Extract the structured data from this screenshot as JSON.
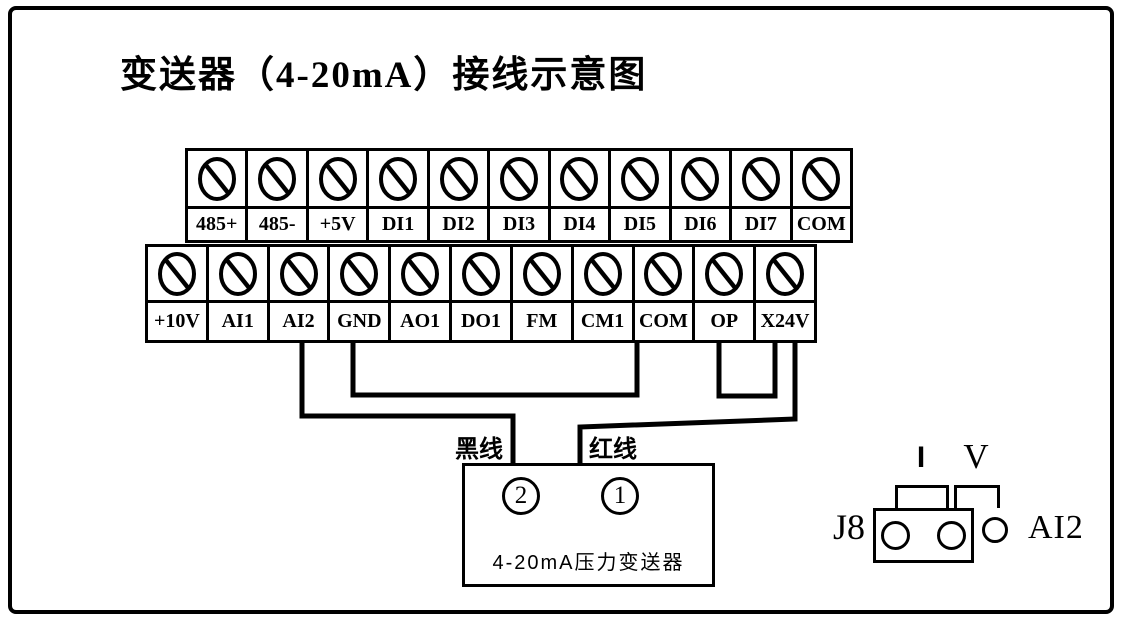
{
  "title": "变送器（4-20mA）接线示意图",
  "terminal_block": {
    "top_row": [
      "485+",
      "485-",
      "+5V",
      "DI1",
      "DI2",
      "DI3",
      "DI4",
      "DI5",
      "DI6",
      "DI7",
      "COM"
    ],
    "bottom_row": [
      "+10V",
      "AI1",
      "AI2",
      "GND",
      "AO1",
      "DO1",
      "FM",
      "CM1",
      "COM",
      "OP",
      "X24V"
    ]
  },
  "wires": {
    "black_label": "黑线",
    "red_label": "红线",
    "connections": [
      {
        "from": "AI2",
        "to": "transmitter-terminal-2",
        "wire": "黑线"
      },
      {
        "from": "GND",
        "to": "COM",
        "type": "jumper"
      },
      {
        "from": "OP",
        "to": "X24V",
        "type": "jumper"
      },
      {
        "from": "X24V",
        "to": "transmitter-terminal-1",
        "wire": "红线"
      }
    ]
  },
  "transmitter": {
    "terminal_2": "2",
    "terminal_1": "1",
    "label": "4-20mA压力变送器"
  },
  "jumper_j8": {
    "name": "J8",
    "mode_current": "I",
    "mode_voltage": "V",
    "signal": "AI2"
  },
  "colors": {
    "line": "#000000",
    "background": "#ffffff"
  }
}
